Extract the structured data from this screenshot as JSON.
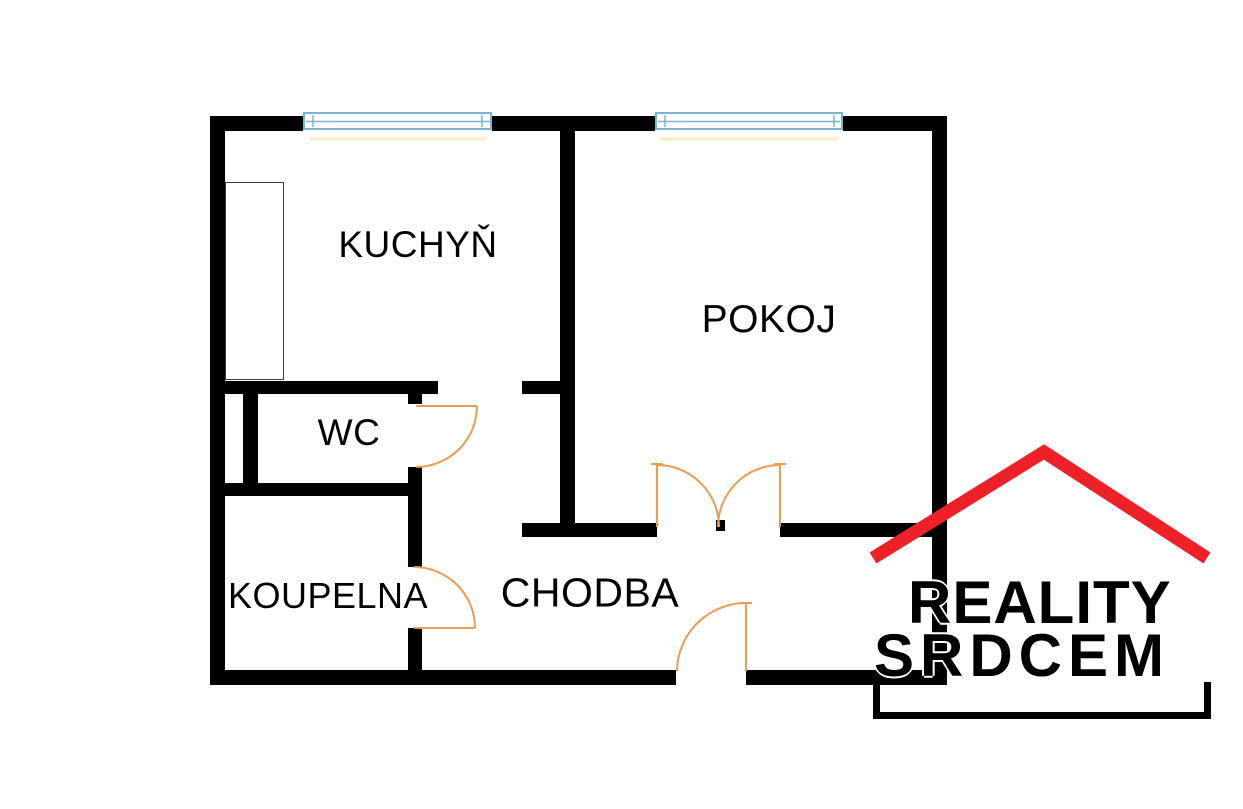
{
  "rooms": {
    "kuchyn": "KUCHYŇ",
    "pokoj": "POKOJ",
    "wc": "WC",
    "koupelna": "KOUPELNA",
    "chodba": "CHODBA"
  },
  "logo": {
    "line1": "REALITY",
    "line2": "SRDCEM"
  },
  "colors": {
    "wall": "#000000",
    "door": "#ed9b52",
    "window": "#79b4d6",
    "window_glow": "#f2ecb4",
    "roof": "#ee2128",
    "text": "#000000",
    "background": "#ffffff",
    "cabinet_outline": "#3a3a3a"
  }
}
